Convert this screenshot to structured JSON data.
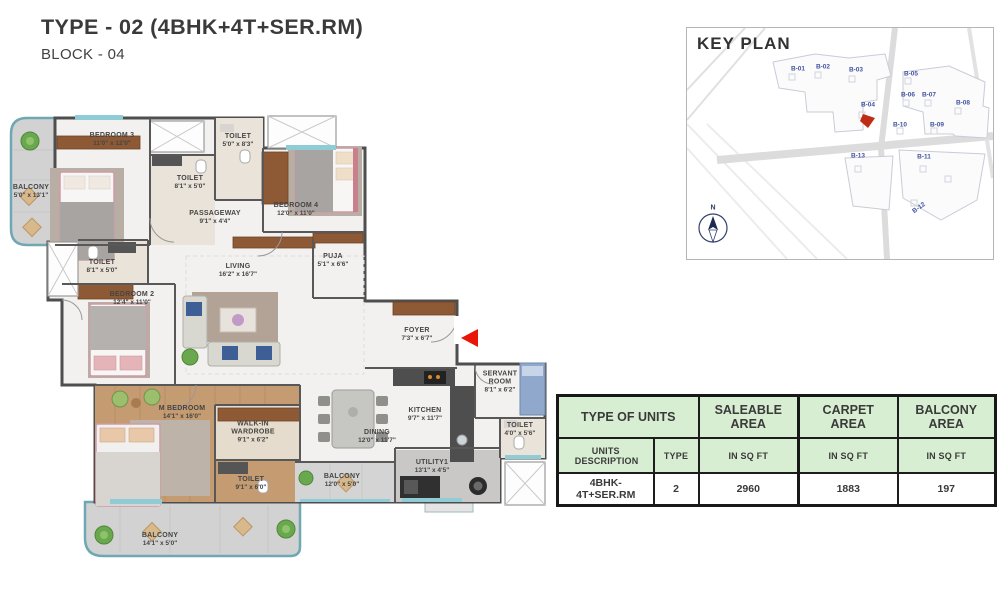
{
  "title": "TYPE - 02 (4BHK+4T+SER.RM)",
  "subtitle": "BLOCK - 04",
  "keyplan": {
    "title": "KEY PLAN",
    "compass_label": "N",
    "blocks": [
      {
        "label": "B-01"
      },
      {
        "label": "B-02"
      },
      {
        "label": "B-03"
      },
      {
        "label": "B-04"
      },
      {
        "label": "B-05"
      },
      {
        "label": "B-06"
      },
      {
        "label": "B-07"
      },
      {
        "label": "B-08"
      },
      {
        "label": "B-09"
      },
      {
        "label": "B-10"
      },
      {
        "label": "B-11"
      },
      {
        "label": "B-12"
      },
      {
        "label": "B-13"
      }
    ]
  },
  "plan": {
    "rooms": [
      {
        "name": "BALCONY",
        "dims": "5'0\" x 13'1\""
      },
      {
        "name": "BEDROOM 3",
        "dims": "11'0\" x 12'0\""
      },
      {
        "name": "TOILET",
        "dims": "8'1\" x 5'0\""
      },
      {
        "name": "TOILET",
        "dims": "5'0\" x 8'3\""
      },
      {
        "name": "BEDROOM 4",
        "dims": "12'0\" x 11'0\""
      },
      {
        "name": "PASSAGEWAY",
        "dims": "9'1\" x 4'4\""
      },
      {
        "name": "TOILET",
        "dims": "8'1\" x 5'0\""
      },
      {
        "name": "BEDROOM 2",
        "dims": "12'4\" x 11'0\""
      },
      {
        "name": "LIVING",
        "dims": "16'2\" x 16'7\""
      },
      {
        "name": "PUJA",
        "dims": "5'1\" x 6'6\""
      },
      {
        "name": "FOYER",
        "dims": "7'3\" x 6'7\""
      },
      {
        "name": "SERVANT ROOM",
        "dims": "8'1\" x 6'2\""
      },
      {
        "name": "KITCHEN",
        "dims": "9'7\" x 11'7\""
      },
      {
        "name": "DINING",
        "dims": "12'0\" x 11'7\""
      },
      {
        "name": "TOILET",
        "dims": "4'0\" x 5'6\""
      },
      {
        "name": "M BEDROOM",
        "dims": "14'1\" x 16'0\""
      },
      {
        "name": "WALK-IN WARDROBE",
        "dims": "9'1\" x 6'2\""
      },
      {
        "name": "TOILET",
        "dims": "9'1\" x 6'0\""
      },
      {
        "name": "BALCONY",
        "dims": "12'0\" x 5'0\""
      },
      {
        "name": "UTILITY1",
        "dims": "13'1\" x 4'5\""
      },
      {
        "name": "BALCONY",
        "dims": "14'1\" x 5'0\""
      }
    ]
  },
  "table": {
    "header_row1": [
      "TYPE OF UNITS",
      "SALEABLE AREA",
      "CARPET AREA",
      "BALCONY AREA"
    ],
    "header_row2": [
      "UNITS DESCRIPTION",
      "TYPE",
      "IN SQ FT",
      "IN SQ FT",
      "IN SQ FT"
    ],
    "row": {
      "description": "4BHK- 4T+SER.RM",
      "type": "2",
      "saleable": "2960",
      "carpet": "1883",
      "balcony": "197"
    }
  },
  "colors": {
    "entry_arrow": "#e81508",
    "table_header_bg": "#d8eed2",
    "balcony_edge": "#6fa7b2",
    "keyplan_label": "#4553a0"
  }
}
